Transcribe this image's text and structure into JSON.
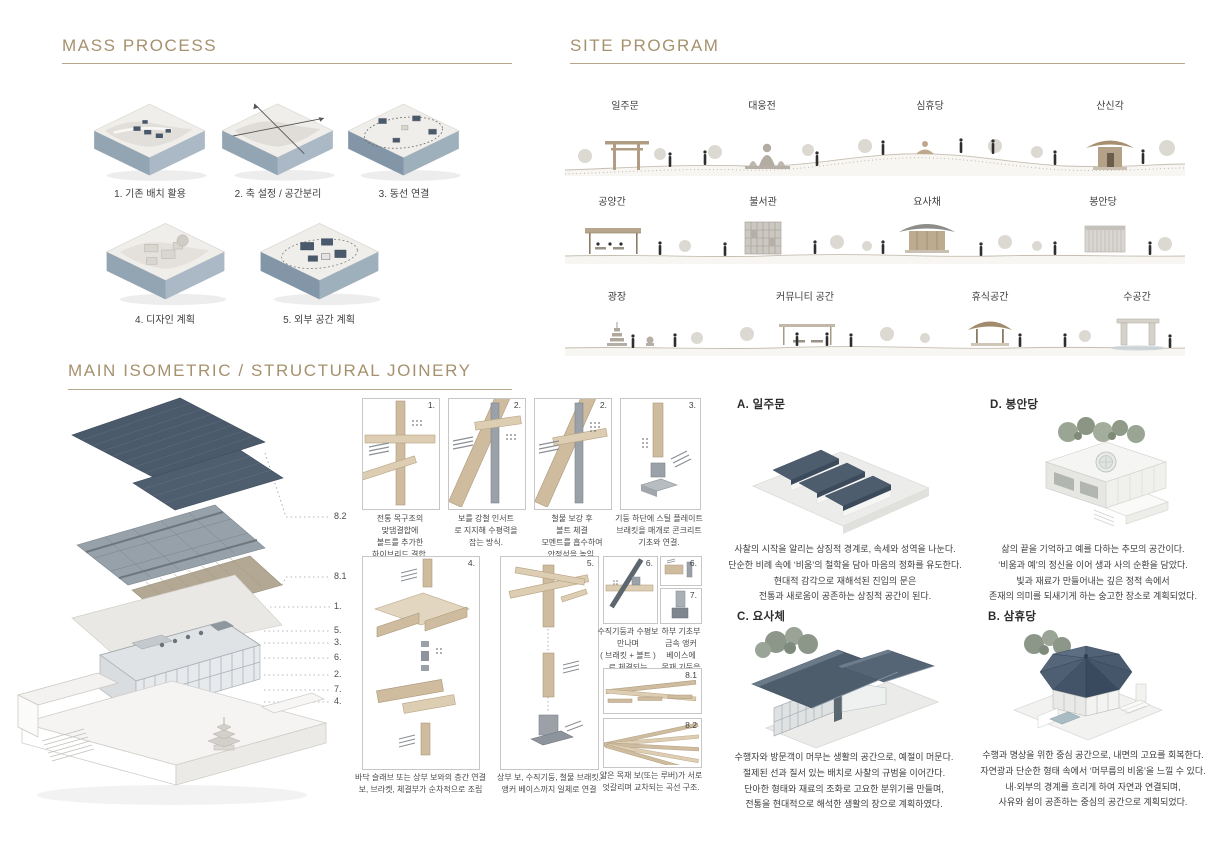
{
  "mass_process": {
    "title": "MASS PROCESS",
    "items": [
      {
        "label": "1. 기존 배치 활용",
        "scene": "terrain-existing-layout"
      },
      {
        "label": "2. 축 설정 / 공간분리",
        "scene": "terrain-axis-division"
      },
      {
        "label": "3. 동선 연결",
        "scene": "terrain-circulation-loop"
      },
      {
        "label": "4. 디자인 계획",
        "scene": "terrain-design-plan"
      },
      {
        "label": "5. 외부 공간 계획",
        "scene": "terrain-exterior-plan"
      }
    ]
  },
  "site_program": {
    "title": "SITE PROGRAM",
    "rows": [
      {
        "labels": [
          "일주문",
          "대웅전",
          "심휴당",
          "산신각"
        ],
        "scene": [
          "torii-gate",
          "buddha-statue",
          "meditating-figure",
          "mountain-shrine-pavilion"
        ]
      },
      {
        "labels": [
          "공양간",
          "불서관",
          "요사채",
          "봉안당"
        ],
        "scene": [
          "dining-canopy",
          "book-hall",
          "traditional-house",
          "louvered-charnel-hall"
        ]
      },
      {
        "labels": [
          "광장",
          "커뮤니티 공간",
          "휴식공간",
          "수공간"
        ],
        "scene": [
          "stone-pagoda",
          "community-gathering",
          "rest-pavilion",
          "water-gate"
        ]
      }
    ]
  },
  "main_section": {
    "title": "MAIN ISOMETRIC / STRUCTURAL JOINERY",
    "exploded_labels": [
      "8.2",
      "8.1",
      "1.",
      "5.",
      "3.",
      "6.",
      "2.",
      "7.",
      "4."
    ]
  },
  "joinery": {
    "panels": [
      {
        "num": "1.",
        "caption": "전통 목구조의\n맞댐결합에\n볼트를 추가한\n하이브리드 결합."
      },
      {
        "num": "2.",
        "caption": "보를 강철 인서트\n로 지지해 수평력을\n잡는 방식."
      },
      {
        "num": "2.",
        "caption": "철물 보강 후\n볼트 체결\n모멘트를 흡수하여\n안정성을 높임."
      },
      {
        "num": "3.",
        "caption": "기둥 하단에 스틸 플레이트\n브래킷을 매개로 콘크리트\n기초와 연결."
      },
      {
        "num": "4.",
        "caption": "바닥 슬래브 또는 상부 보와의 층간 연결\n보, 브라켓, 체결부가 순차적으로 조립"
      },
      {
        "num": "5.",
        "caption": "상부 보, 수직기둥, 철물 브래킷,\n앵커 베이스까지 일체로 연결"
      },
      {
        "num": "6.",
        "caption": "수직기둥과 수평보\n만나며\n( 브래킷 + 볼트 )\n로 체결되는\n교차 결구."
      },
      {
        "num": "6.",
        "caption": ""
      },
      {
        "num": "7.",
        "caption": "하부 기초부\n금속 앵커\n베이스에\n목재 기둥을\n삽입·체결."
      },
      {
        "num": "8.1",
        "caption": ""
      },
      {
        "num": "8.2",
        "caption": "얇은 목재 보(또는 루버)가 서로\n엇갈리며 교차되는 곡선 구조."
      }
    ]
  },
  "buildings": [
    {
      "title": "A. 일주문",
      "desc": "사찰의 시작을 알리는 상징적 경계로, 속세와 성역을 나눈다.\n단순한 비례 속에 ‘비움’의 철학을 담아 마음의 정화를 유도한다.\n현대적 감각으로 재해석된 진입의 문은\n전통과 새로움이 공존하는 상징적 공간이 된다."
    },
    {
      "title": "D. 봉안당",
      "desc": "삶의 끝을 기억하고 예를 다하는 추모의 공간이다.\n‘비움과 예’의 정신을 이어 생과 사의 순환을 담았다.\n빛과 재료가 만들어내는 깊은 정적 속에서\n존재의 의미를 되새기게 하는 숭고한 장소로 계획되었다."
    },
    {
      "title": "C. 요사체",
      "desc": "수행자와 방문객이 머무는 생활의 공간으로, 예절이 머문다.\n절제된 선과 질서 있는 배치로 사찰의 규범을 이어간다.\n단아한 형태와 재료의 조화로 고요한 분위기를 만들며,\n전통을 현대적으로 해석한 생활의 장으로 계획하였다."
    },
    {
      "title": "B. 삼휴당",
      "desc": "수행과 명상을 위한 중심 공간으로, 내면의 고요를 회복한다.\n자연광과 단순한 형태 속에서 ‘머무름의 비움’을 느낄 수 있다.\n내·외부의 경계를 흐리게 하여 자연과 연결되며,\n사유와 쉼이 공존하는 중심의 공간으로 계획되었다."
    }
  ],
  "colors": {
    "accent_tan": "#a6916e",
    "rule": "#b9a98c",
    "roof_blue": "#4b5a6a",
    "wood": "#cfbc9f",
    "steel": "#9aa1a8"
  }
}
